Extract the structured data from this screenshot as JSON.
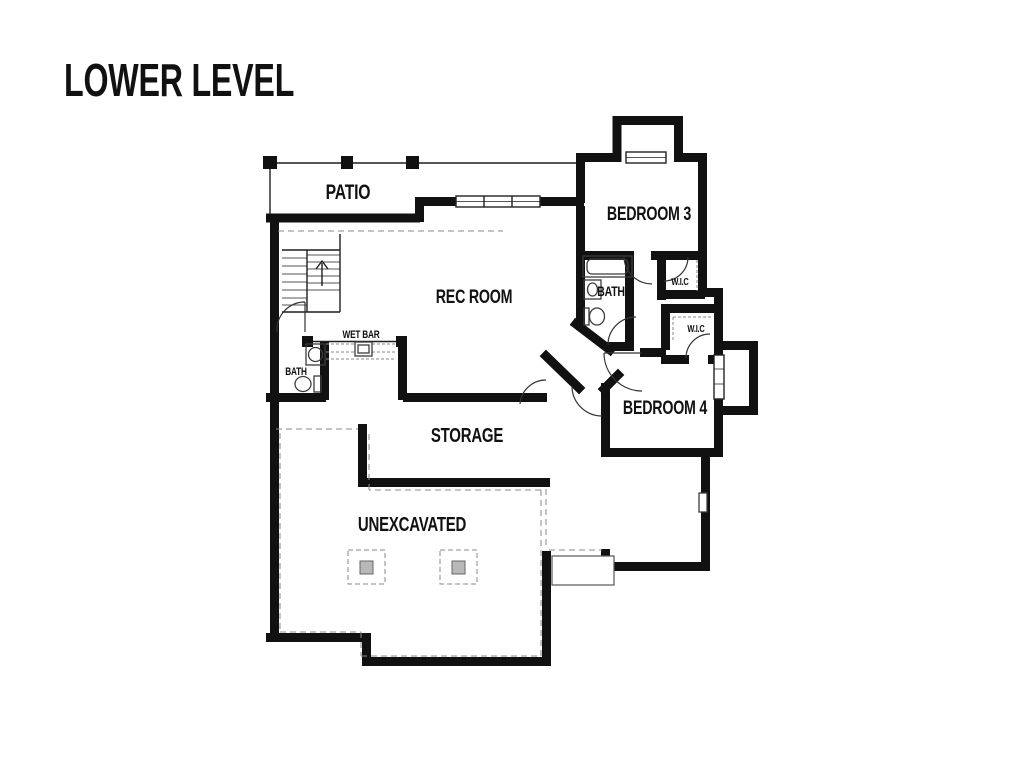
{
  "title": "LOWER LEVEL",
  "rooms": {
    "patio": {
      "label": "PATIO"
    },
    "rec_room": {
      "label": "REC ROOM"
    },
    "bedroom3": {
      "label": "BEDROOM 3"
    },
    "bathroom3": {
      "label": "BATH"
    },
    "wic_upper": {
      "label": "W.I.C"
    },
    "wic_lower": {
      "label": "W.I.C"
    },
    "bedroom4": {
      "label": "BEDROOM 4"
    },
    "wet_bar": {
      "label": "WET BAR"
    },
    "bath_lower": {
      "label": "BATH"
    },
    "storage": {
      "label": "STORAGE"
    },
    "unexcavated": {
      "label": "UNEXCAVATED"
    }
  },
  "colors": {
    "background": "#ffffff",
    "wall": "#111111",
    "thin_line": "#1f1f1f",
    "dashed_line": "#8a8a8a",
    "fixture": "#3c3c3c",
    "post_fill": "#b8b8b8",
    "text": "#111111"
  }
}
